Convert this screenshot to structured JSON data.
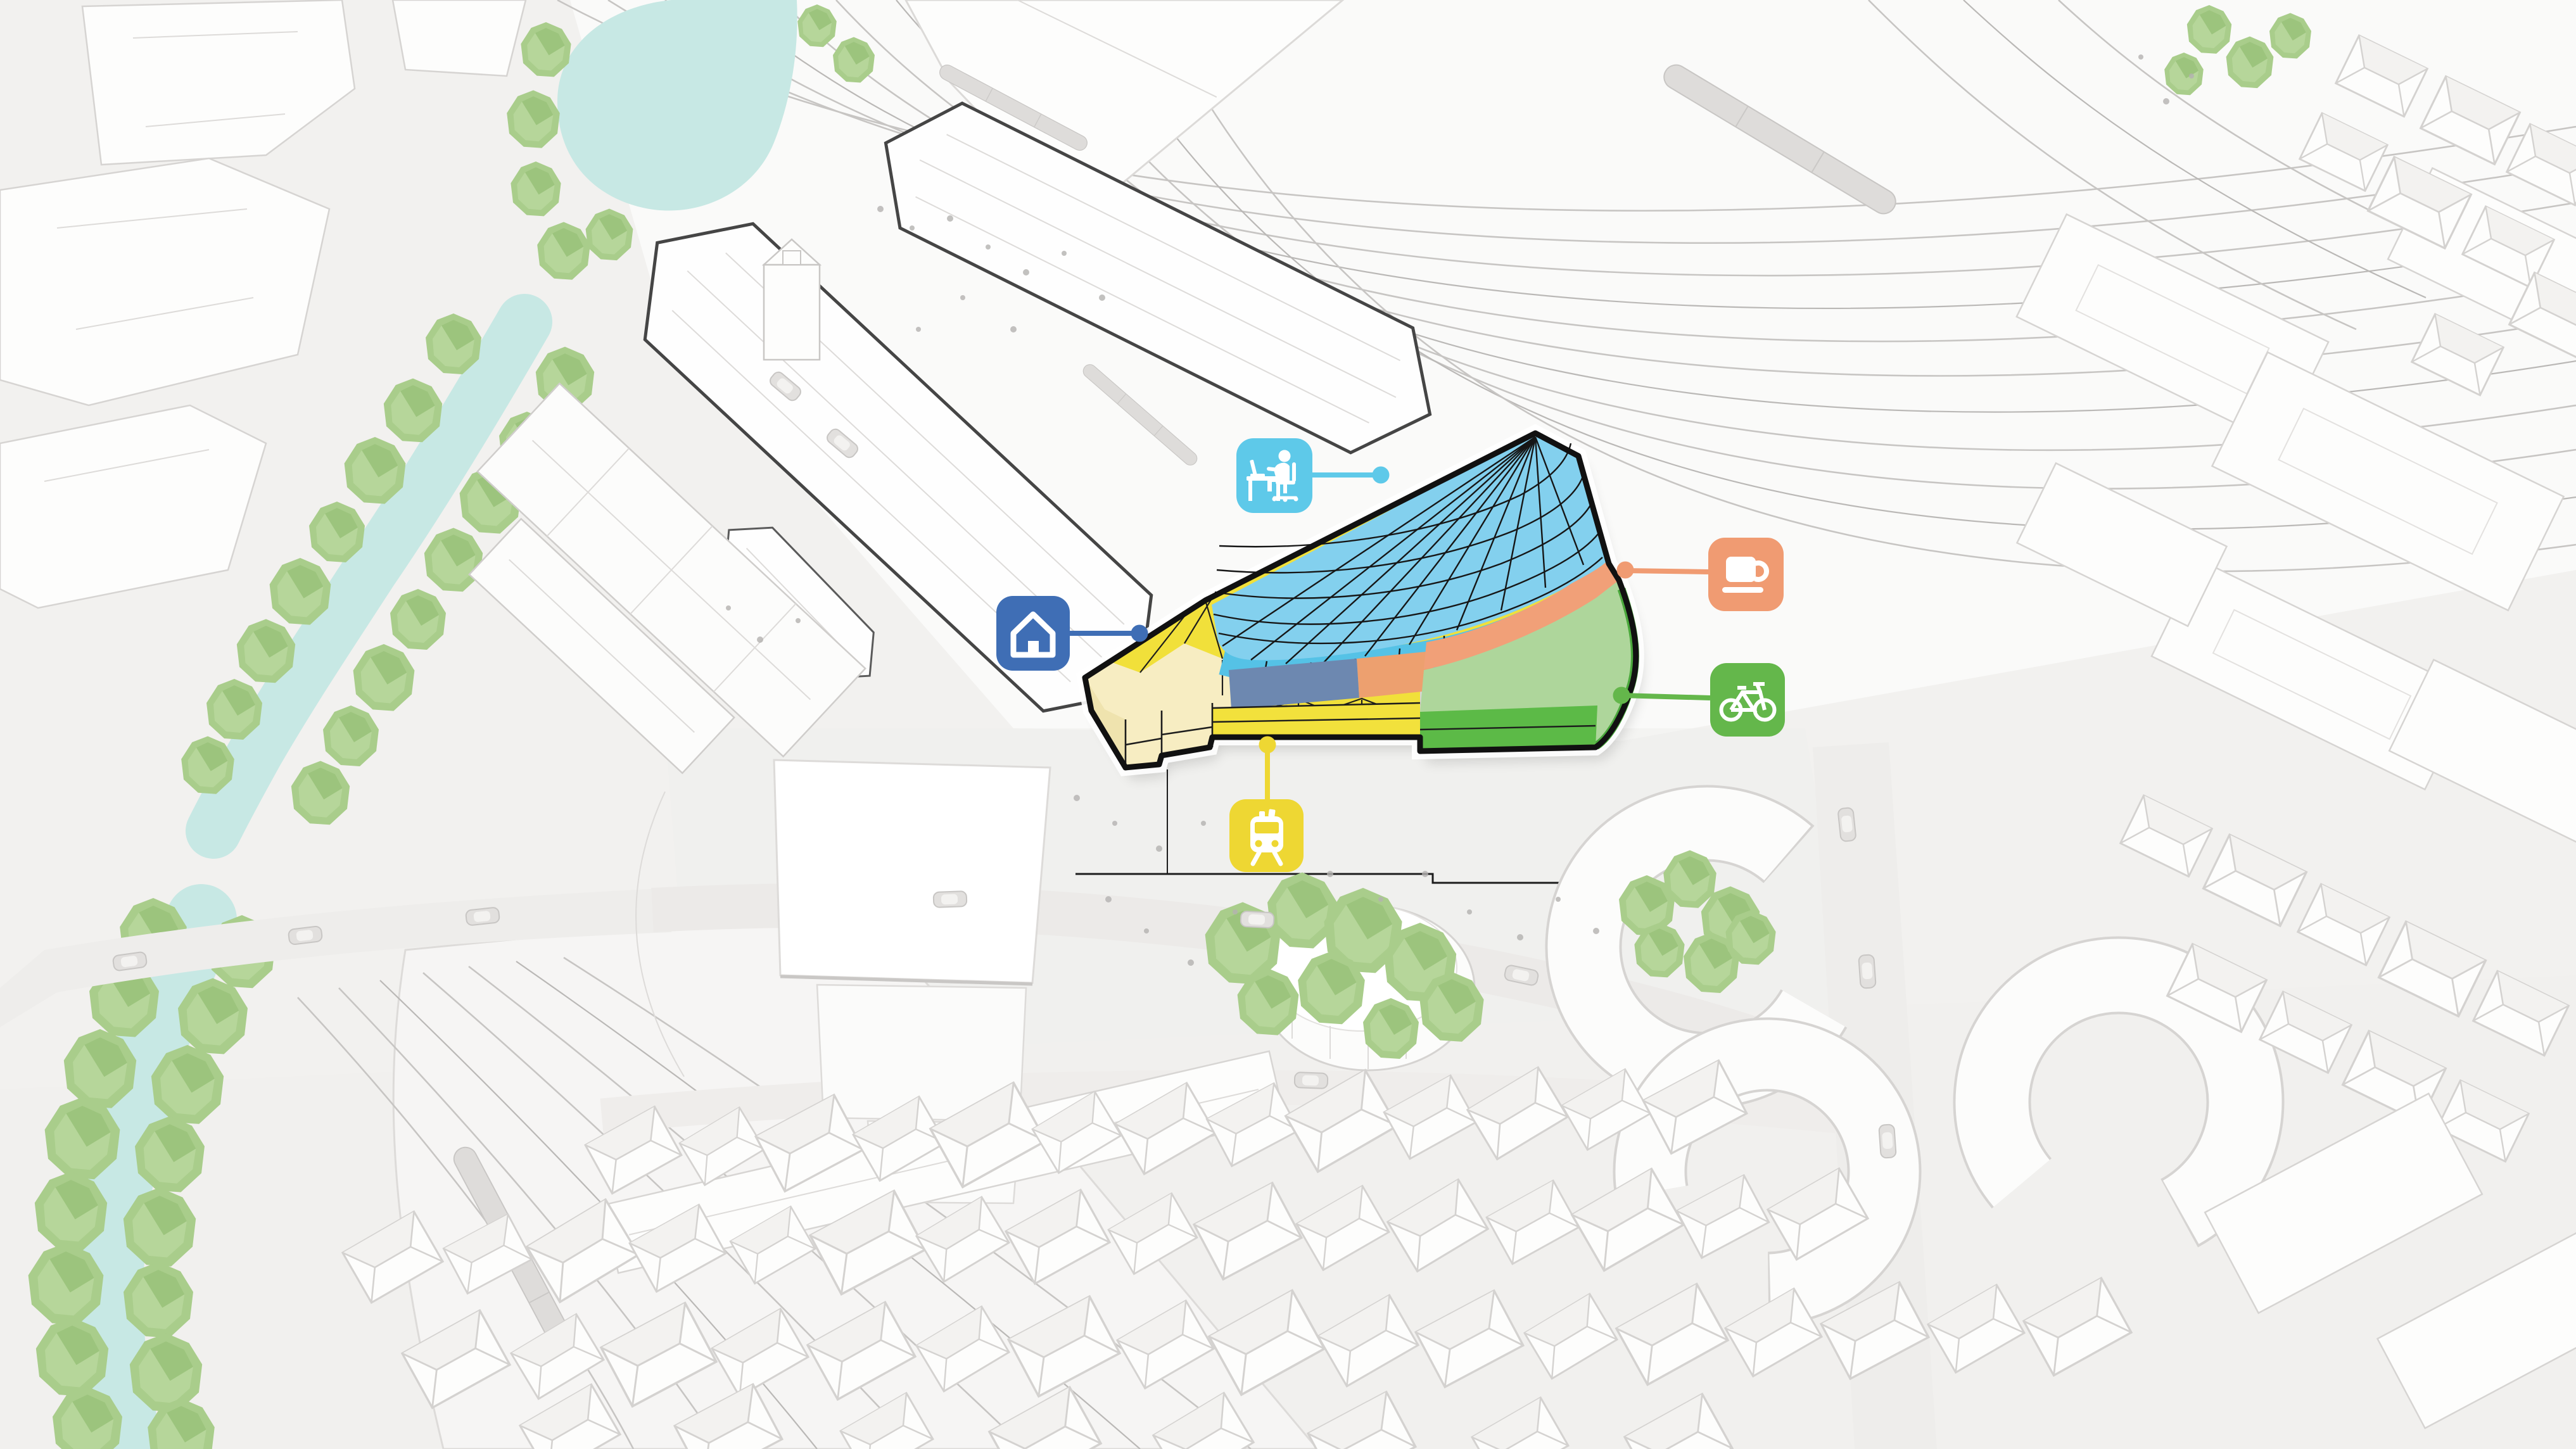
{
  "figure": {
    "type": "axonometric-site-diagram",
    "subject": "Railway station district massing model with a highlighted mixed-use development and five program icon callouts"
  },
  "palette": {
    "background": "#f2f1ef",
    "model_fill": "#fdfdfc",
    "model_line": "#d6d4d2",
    "canopy_outline": "#454545",
    "track_line": "#c7c5c3",
    "water": "#c7e8e4",
    "tree": "#a9cd8b",
    "tree_shade": "#93bd74",
    "people": "#b4b2b0",
    "site_outline": "#111111"
  },
  "building": {
    "outline_color": "#111111",
    "zones": {
      "office": {
        "roof": "#83d0ee",
        "wall": "#55c2e6",
        "band": "#6d88b0"
      },
      "cafe": {
        "band": "#f1a078",
        "block": "#eda06f"
      },
      "bike": {
        "roof": "#aed69b",
        "base": "#5cba47",
        "edge": "#4aa83c"
      },
      "rail": {
        "roof": "#f1e03a",
        "canopy": "#f7edc2",
        "fascia": "#f2e13c",
        "face": "#efe3ae"
      }
    }
  },
  "callouts": {
    "office": {
      "icon": "office-desk-icon",
      "color": "#5ec9e9"
    },
    "cafe": {
      "icon": "coffee-cup-icon",
      "color": "#f09b72"
    },
    "home": {
      "icon": "house-icon",
      "color": "#3f6eb5"
    },
    "bike": {
      "icon": "bicycle-icon",
      "color": "#64b74b"
    },
    "rail": {
      "icon": "train-icon",
      "color": "#eed733"
    }
  }
}
